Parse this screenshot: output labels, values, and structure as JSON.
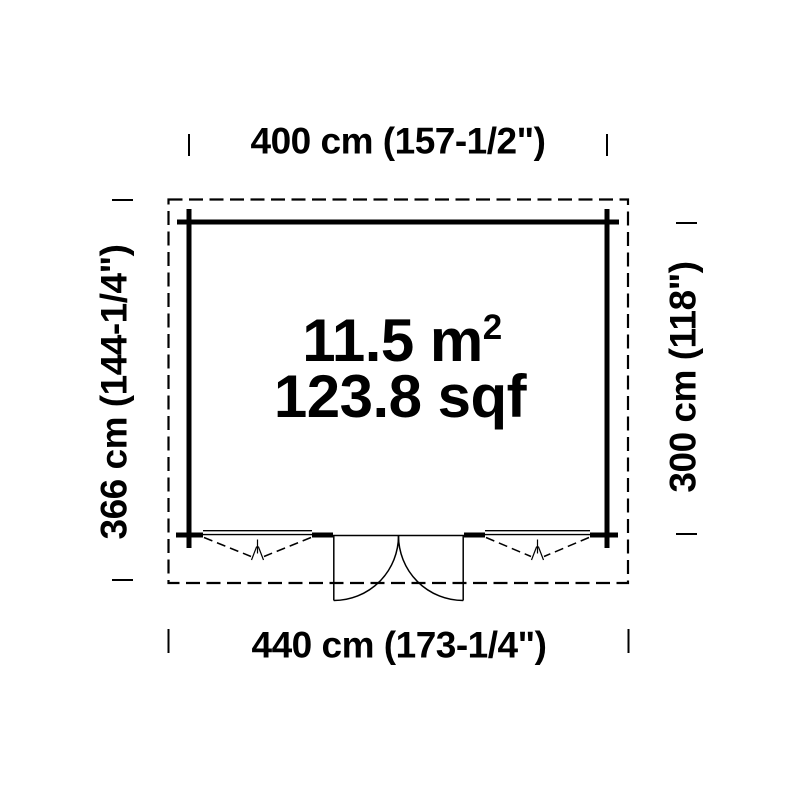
{
  "plan": {
    "dim_top": "400 cm (157-1/2\")",
    "dim_bottom": "440 cm (173-1/4\")",
    "dim_left": "366 cm (144-1/4\")",
    "dim_right": "300 cm (118\")",
    "area_metric": "11.5 m",
    "area_metric_sup": "2",
    "area_imperial": "123.8 sqf"
  },
  "symbols": {
    "door": "double-swing-door",
    "window_left": "tilt-window",
    "window_right": "tilt-window",
    "outline": "roof-overhang-dashed-outline"
  },
  "colors": {
    "line": "#000000",
    "background": "#ffffff"
  }
}
